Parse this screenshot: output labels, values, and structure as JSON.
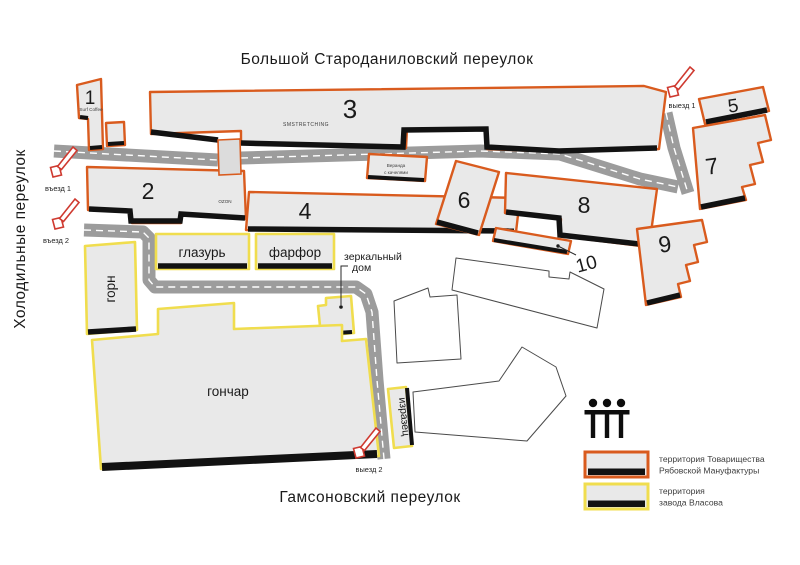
{
  "streets": {
    "top": "Большой Староданиловский переулок",
    "left": "Холодильные переулок",
    "bottom": "Гамсоновский переулок"
  },
  "buildings": {
    "b1": {
      "number": "1",
      "tenant": "Surf Coffee"
    },
    "b2": {
      "number": "2",
      "tenant": "OZON"
    },
    "b3": {
      "number": "3",
      "tenant": "SMSTRETCHING"
    },
    "b4": {
      "number": "4"
    },
    "b5": {
      "number": "5"
    },
    "b6": {
      "number": "6"
    },
    "b7": {
      "number": "7"
    },
    "b8": {
      "number": "8"
    },
    "b9": {
      "number": "9"
    },
    "b10": {
      "number": "10"
    },
    "gorn": {
      "name": "горн"
    },
    "glazur": {
      "name": "глазурь"
    },
    "farfor": {
      "name": "фарфор"
    },
    "gonchar": {
      "name": "гончар"
    },
    "izrazets": {
      "name": "изразец"
    },
    "mirror_house": {
      "name_line1": "зеркальный",
      "name_line2": "дом"
    },
    "veranda": {
      "name_line1": "Веранда",
      "name_line2": "с качелями"
    }
  },
  "markers": {
    "entrance1": "въезд 1",
    "entrance2": "въезд 2",
    "exit1": "выезд 1",
    "exit2": "выезд 2"
  },
  "legend": {
    "manufactory_line1": "территория  Товарищества",
    "manufactory_line2": "Рябовской Мануфактуры",
    "vlasov_line1": "территория",
    "vlasov_line2": "завода Власова"
  },
  "colors": {
    "manufactory_outline": "#d95b1e",
    "vlasov_outline": "#f0dd4e",
    "building_fill": "#e9e9e9",
    "road": "#9c9c9c",
    "arrow_red": "#cf3a30",
    "edge_black": "#121212"
  }
}
